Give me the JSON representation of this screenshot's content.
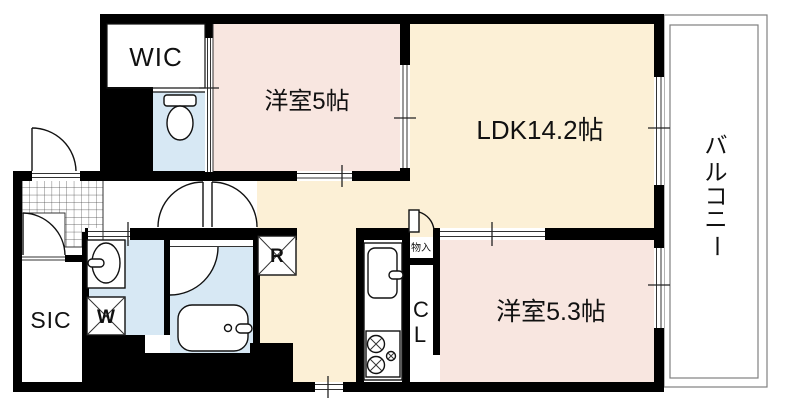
{
  "floorplan": {
    "rooms": {
      "wic": {
        "label": "WIC"
      },
      "western_room_5": {
        "label": "洋室5帖"
      },
      "ldk": {
        "label": "LDK14.2帖"
      },
      "western_room_5_3": {
        "label": "洋室5.3帖"
      },
      "balcony": {
        "label": "バルコニー",
        "chars": [
          "バ",
          "ル",
          "コ",
          "ニ",
          "ー"
        ]
      },
      "sic": {
        "label": "SIC"
      },
      "closet": {
        "label": "CL",
        "chars": [
          "C",
          "L"
        ]
      },
      "storage": {
        "label": "物入"
      }
    },
    "fixtures": {
      "washer": {
        "label": "W"
      },
      "refrigerator": {
        "label": "R"
      }
    },
    "colors": {
      "room_pink": "#f8e6e0",
      "room_cream": "#fcf0d6",
      "room_wet_blue": "#d7e8f4",
      "wall": "#000000",
      "balcony_line": "#808080"
    }
  }
}
